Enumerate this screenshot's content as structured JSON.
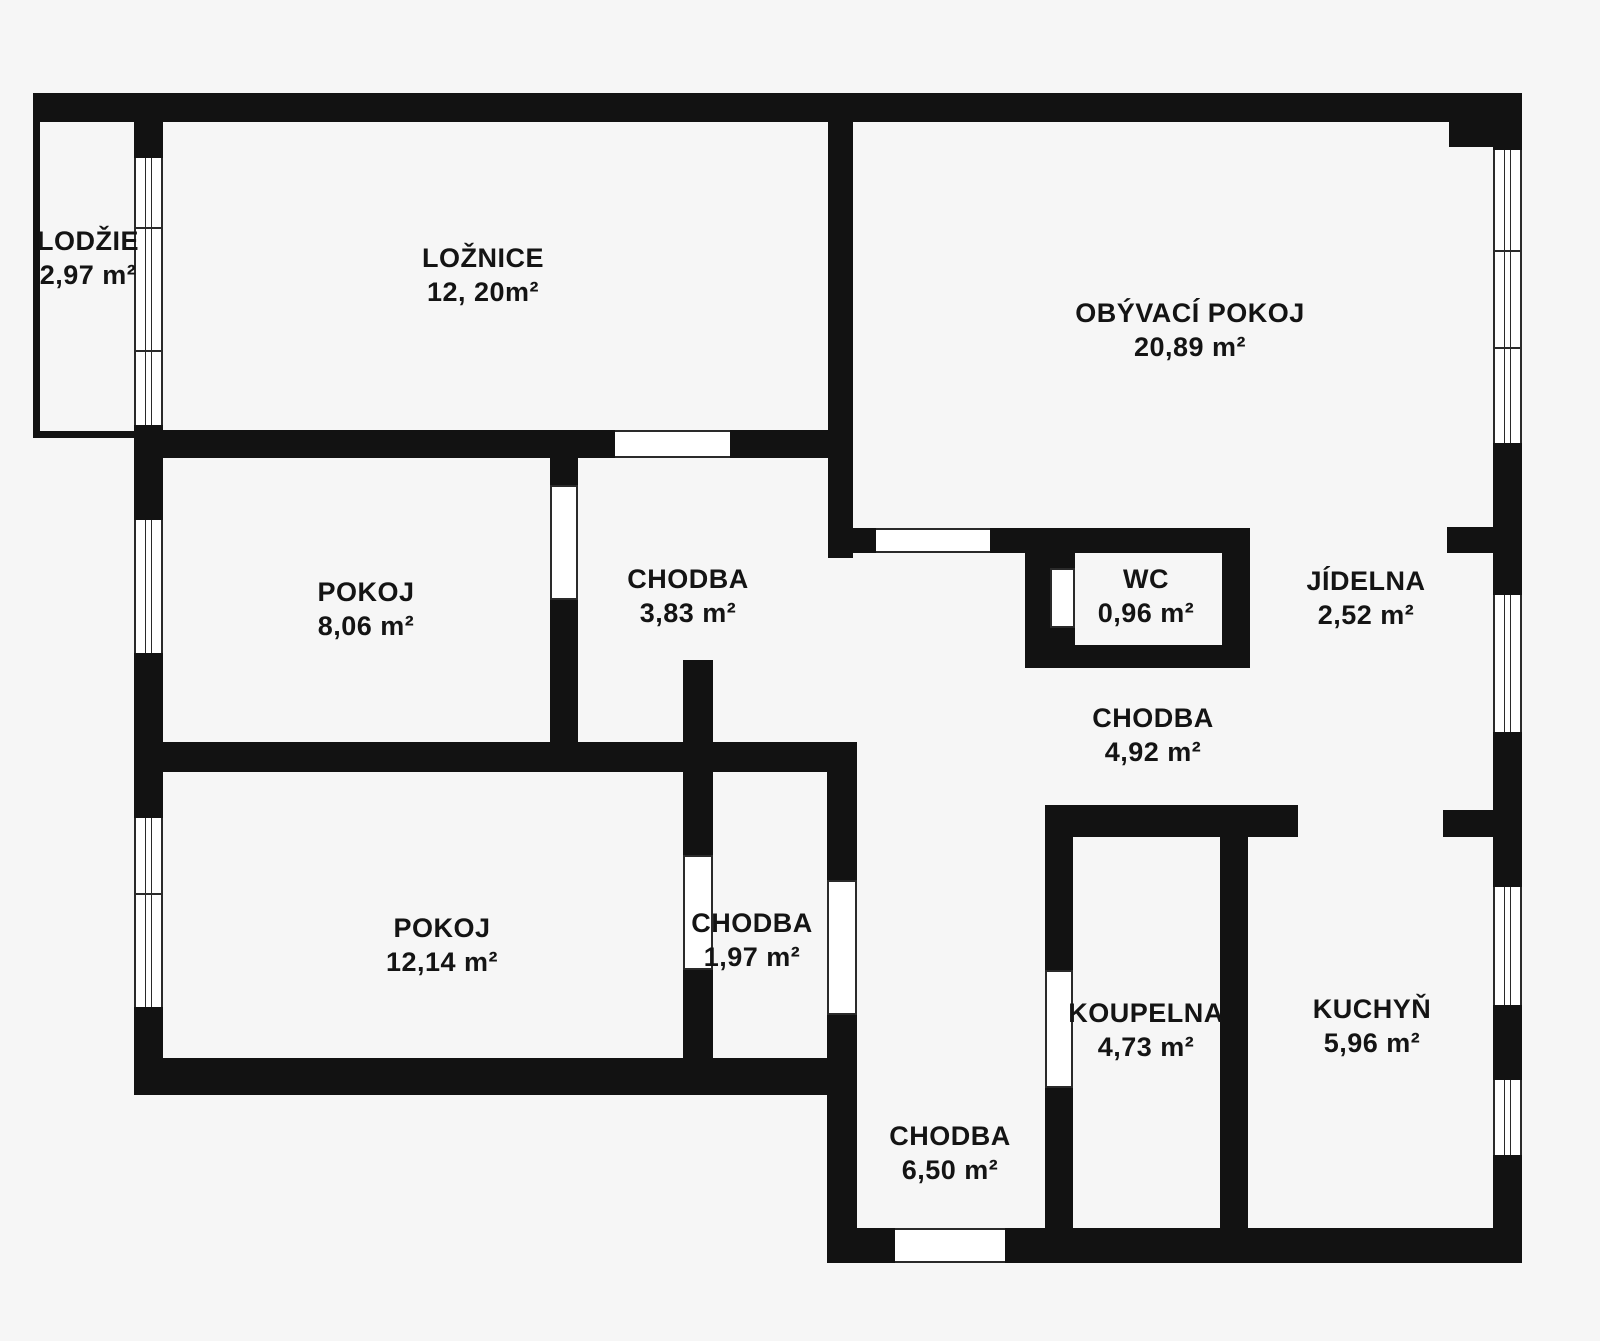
{
  "canvas": {
    "width": 1600,
    "height": 1341,
    "background": "#f6f6f6",
    "wall_color": "#121212",
    "text_color": "#141414",
    "line_color": "#2a2a2a"
  },
  "rooms": [
    {
      "id": "lodzie",
      "name": "LODŽIE",
      "area": "2,97 m²",
      "cx": 88,
      "cy": 258
    },
    {
      "id": "loznice",
      "name": "LOŽNICE",
      "area": "12, 20m²",
      "cx": 483,
      "cy": 275
    },
    {
      "id": "obyvaci-pokoj",
      "name": "OBÝVACÍ POKOJ",
      "area": "20,89 m²",
      "cx": 1190,
      "cy": 330
    },
    {
      "id": "pokoj-horni",
      "name": "POKOJ",
      "area": "8,06 m²",
      "cx": 366,
      "cy": 609
    },
    {
      "id": "chodba-horni",
      "name": "CHODBA",
      "area": "3,83 m²",
      "cx": 688,
      "cy": 596
    },
    {
      "id": "wc",
      "name": "WC",
      "area": "0,96 m²",
      "cx": 1146,
      "cy": 596
    },
    {
      "id": "jidelna",
      "name": "JÍDELNA",
      "area": "2,52 m²",
      "cx": 1366,
      "cy": 598
    },
    {
      "id": "chodba-stredni",
      "name": "CHODBA",
      "area": "4,92 m²",
      "cx": 1153,
      "cy": 735
    },
    {
      "id": "pokoj-dolni",
      "name": "POKOJ",
      "area": "12,14 m²",
      "cx": 442,
      "cy": 945
    },
    {
      "id": "chodba-mala",
      "name": "CHODBA",
      "area": "1,97 m²",
      "cx": 752,
      "cy": 940
    },
    {
      "id": "koupelna",
      "name": "KOUPELNA",
      "area": "4,73 m²",
      "cx": 1146,
      "cy": 1030
    },
    {
      "id": "kuchyn",
      "name": "KUCHYŇ",
      "area": "5,96 m²",
      "cx": 1372,
      "cy": 1026
    },
    {
      "id": "chodba-vstup",
      "name": "CHODBA",
      "area": "6,50 m²",
      "cx": 950,
      "cy": 1153
    }
  ],
  "walls": [
    {
      "x": 33,
      "y": 93,
      "w": 1489,
      "h": 29
    },
    {
      "x": 1449,
      "y": 122,
      "w": 44,
      "h": 25
    },
    {
      "x": 1493,
      "y": 93,
      "w": 29,
      "h": 57
    },
    {
      "x": 1493,
      "y": 443,
      "w": 29,
      "h": 152
    },
    {
      "x": 1493,
      "y": 732,
      "w": 29,
      "h": 155
    },
    {
      "x": 1493,
      "y": 1005,
      "w": 29,
      "h": 75
    },
    {
      "x": 1493,
      "y": 1155,
      "w": 29,
      "h": 108
    },
    {
      "x": 1447,
      "y": 527,
      "w": 46,
      "h": 26
    },
    {
      "x": 1443,
      "y": 810,
      "w": 50,
      "h": 27
    },
    {
      "x": 134,
      "y": 93,
      "w": 29,
      "h": 65
    },
    {
      "x": 134,
      "y": 425,
      "w": 29,
      "h": 95
    },
    {
      "x": 134,
      "y": 653,
      "w": 29,
      "h": 165
    },
    {
      "x": 134,
      "y": 1007,
      "w": 29,
      "h": 88
    },
    {
      "x": 33,
      "y": 122,
      "w": 7,
      "h": 316
    },
    {
      "x": 33,
      "y": 431,
      "w": 101,
      "h": 7
    },
    {
      "x": 163,
      "y": 430,
      "w": 452,
      "h": 28
    },
    {
      "x": 730,
      "y": 430,
      "w": 123,
      "h": 28
    },
    {
      "x": 828,
      "y": 122,
      "w": 25,
      "h": 436
    },
    {
      "x": 853,
      "y": 528,
      "w": 23,
      "h": 25
    },
    {
      "x": 990,
      "y": 528,
      "w": 260,
      "h": 25
    },
    {
      "x": 550,
      "y": 458,
      "w": 28,
      "h": 27
    },
    {
      "x": 550,
      "y": 600,
      "w": 28,
      "h": 172
    },
    {
      "x": 163,
      "y": 742,
      "w": 694,
      "h": 30
    },
    {
      "x": 683,
      "y": 660,
      "w": 30,
      "h": 82
    },
    {
      "x": 683,
      "y": 772,
      "w": 30,
      "h": 83
    },
    {
      "x": 683,
      "y": 970,
      "w": 30,
      "h": 88
    },
    {
      "x": 134,
      "y": 1058,
      "w": 723,
      "h": 37
    },
    {
      "x": 827,
      "y": 742,
      "w": 30,
      "h": 138
    },
    {
      "x": 827,
      "y": 1015,
      "w": 30,
      "h": 248
    },
    {
      "x": 1025,
      "y": 553,
      "w": 25,
      "h": 92
    },
    {
      "x": 1050,
      "y": 553,
      "w": 25,
      "h": 15
    },
    {
      "x": 1050,
      "y": 628,
      "w": 25,
      "h": 17
    },
    {
      "x": 1025,
      "y": 645,
      "w": 225,
      "h": 23
    },
    {
      "x": 1222,
      "y": 528,
      "w": 28,
      "h": 140
    },
    {
      "x": 1045,
      "y": 805,
      "w": 253,
      "h": 32
    },
    {
      "x": 1045,
      "y": 837,
      "w": 28,
      "h": 133
    },
    {
      "x": 1045,
      "y": 1088,
      "w": 28,
      "h": 140
    },
    {
      "x": 1220,
      "y": 837,
      "w": 28,
      "h": 391
    },
    {
      "x": 827,
      "y": 1228,
      "w": 68,
      "h": 35
    },
    {
      "x": 1005,
      "y": 1228,
      "w": 517,
      "h": 35
    }
  ],
  "doors": [
    {
      "x": 615,
      "y": 430,
      "w": 115,
      "h": 28,
      "orientation": "h"
    },
    {
      "x": 550,
      "y": 485,
      "w": 28,
      "h": 115,
      "orientation": "v"
    },
    {
      "x": 876,
      "y": 528,
      "w": 114,
      "h": 25,
      "orientation": "h"
    },
    {
      "x": 1050,
      "y": 568,
      "w": 25,
      "h": 60,
      "orientation": "v"
    },
    {
      "x": 683,
      "y": 855,
      "w": 30,
      "h": 115,
      "orientation": "v"
    },
    {
      "x": 827,
      "y": 880,
      "w": 30,
      "h": 135,
      "orientation": "v"
    },
    {
      "x": 1045,
      "y": 970,
      "w": 28,
      "h": 118,
      "orientation": "v"
    },
    {
      "x": 895,
      "y": 1228,
      "w": 110,
      "h": 35,
      "orientation": "h"
    }
  ],
  "windows": [
    {
      "x": 134,
      "y": 158,
      "w": 29,
      "h": 267,
      "dividers": [
        227,
        350
      ]
    },
    {
      "x": 134,
      "y": 520,
      "w": 29,
      "h": 133,
      "dividers": []
    },
    {
      "x": 134,
      "y": 818,
      "w": 29,
      "h": 189,
      "dividers": [
        893
      ]
    },
    {
      "x": 1493,
      "y": 150,
      "w": 29,
      "h": 293,
      "dividers": [
        250,
        347
      ]
    },
    {
      "x": 1493,
      "y": 595,
      "w": 29,
      "h": 137,
      "dividers": []
    },
    {
      "x": 1493,
      "y": 887,
      "w": 29,
      "h": 118,
      "dividers": []
    },
    {
      "x": 1493,
      "y": 1080,
      "w": 29,
      "h": 75,
      "dividers": []
    }
  ]
}
